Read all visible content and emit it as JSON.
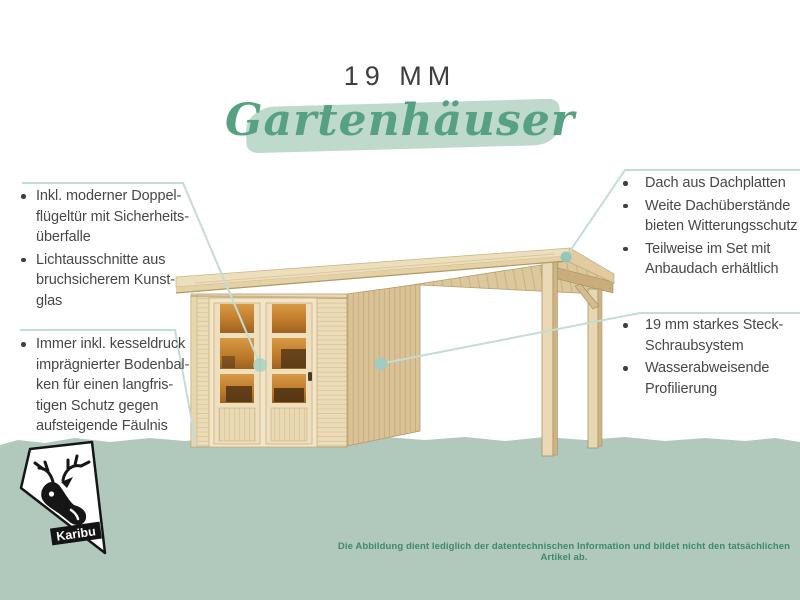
{
  "header": {
    "size_label": "19 MM",
    "title": "Gartenhäuser"
  },
  "callouts": {
    "left_top": {
      "items": [
        {
          "lines": [
            "Inkl. moderner Doppel-",
            "flügeltür mit Sicherheits-",
            "überfalle"
          ]
        },
        {
          "lines": [
            "Lichtausschnitte aus",
            "bruchsicherem Kunst-",
            "glas"
          ]
        }
      ]
    },
    "left_bottom": {
      "items": [
        {
          "lines": [
            "Immer inkl. kesseldruck",
            "imprägnierter Bodenbal-",
            "ken für einen langfris-",
            "tigen Schutz gegen",
            "aufsteigende Fäulnis"
          ]
        }
      ]
    },
    "right_top": {
      "items": [
        {
          "lines": [
            "Dach aus Dachplatten"
          ]
        },
        {
          "lines": [
            "Weite Dachüberstände",
            "bieten Witterungsschutz"
          ]
        },
        {
          "lines": [
            "Teilweise im Set mit",
            "Anbaudach erhältlich"
          ]
        }
      ]
    },
    "right_bottom": {
      "items": [
        {
          "lines": [
            "19 mm starkes Steck-",
            "Schraubsystem"
          ]
        },
        {
          "lines": [
            "Wasserabweisende",
            "Profilierung"
          ]
        }
      ]
    }
  },
  "footer": {
    "disclaimer": "Die Abbildung dient lediglich der datentechnischen Information und bildet nicht den tatsächlichen Artikel ab.",
    "logo_brand": "Karibu"
  },
  "colors": {
    "script_title_green": "#55a181",
    "brush_stroke_green": "#bfdacd",
    "ground_band_green": "#b1c9bc",
    "callout_line_teal": "#c3dcd5",
    "callout_dot_teal": "#93c7bd",
    "body_text": "#474747",
    "disclaimer_green": "#3d8a68",
    "wood_light": "#eddeba",
    "wood_side": "#d9c295",
    "door_glass_amber": "#c9842f",
    "logo_black": "#161616"
  }
}
